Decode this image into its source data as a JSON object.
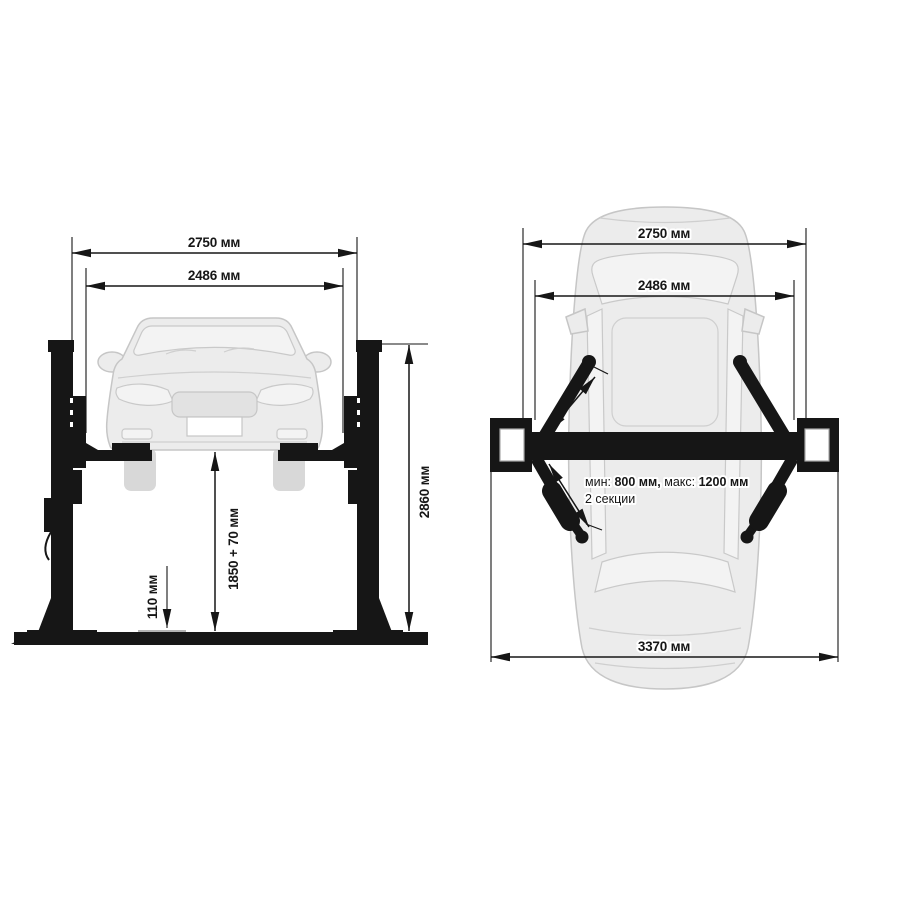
{
  "diagram": {
    "subject": "two-post car lift dimensional drawing",
    "background": "#ffffff",
    "colors": {
      "ink": "#161616",
      "car_fill": "#ececec",
      "car_line": "#c8c8c8",
      "reference_gray": "#9a9a9a"
    }
  },
  "front_view": {
    "dim_width_outer": "2750 мм",
    "dim_width_inner": "2486 мм",
    "dim_height_overall": "2860 мм",
    "dim_lift_height": "1850 + 70 мм",
    "dim_pad_min_height": "110 мм"
  },
  "top_view": {
    "dim_width_outer": "2750 мм",
    "dim_width_inner": "2486 мм",
    "dim_overall_length": "3370 мм",
    "arm_reach": {
      "min_label": "мин:",
      "min_value": "800 мм,",
      "max_label": "макс:",
      "max_value": "1200 мм",
      "sections": "2 секции"
    }
  }
}
